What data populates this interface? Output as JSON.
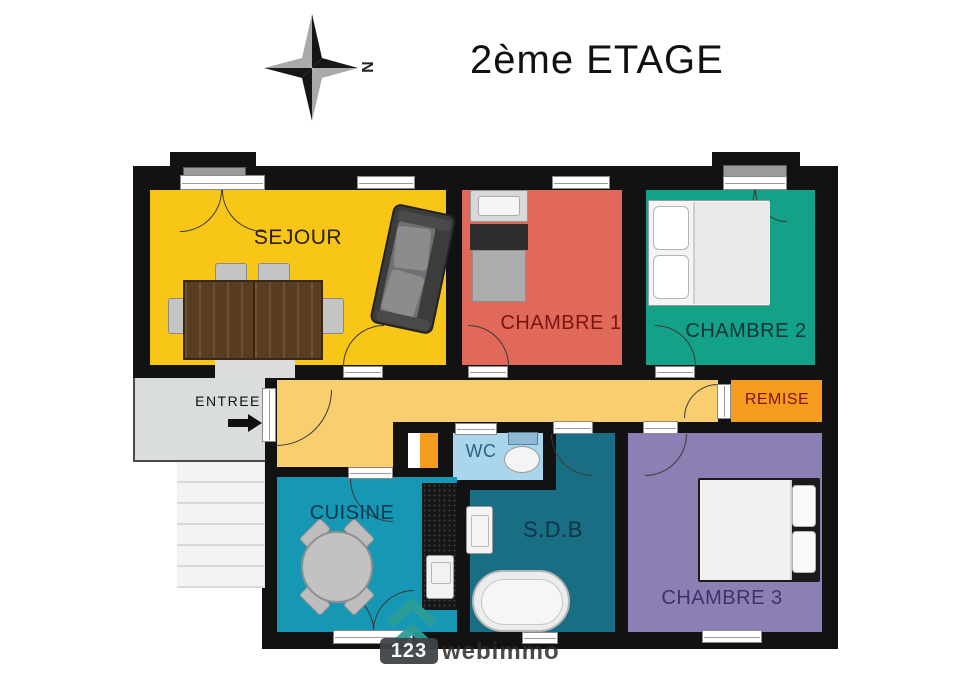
{
  "header": {
    "title": "2ème ETAGE",
    "compass_label": "N"
  },
  "colors": {
    "wall": "#121212",
    "sejour": "#F8C617",
    "hallway": "#F8CE6E",
    "chambre1": "#E0695A",
    "chambre2": "#13A287",
    "remise": "#F59B1E",
    "closet": "#F59B1E",
    "cuisine": "#1697B4",
    "wc": "#A9D6EA",
    "sdb": "#1A6E84",
    "chambre3": "#8C7FB4",
    "entree": "#D9DDDE",
    "watermark_teal": "#2D9E98"
  },
  "label_colors": {
    "sejour": "#2B1E04",
    "chambre1": "#7B150F",
    "chambre2": "#14323B",
    "remise": "#7B150F",
    "entree": "#111111",
    "wc": "#2B6285",
    "cuisine": "#0D3950",
    "sdb": "#0E3448",
    "chambre3": "#43306B"
  },
  "rooms": {
    "sejour": {
      "label": "SEJOUR"
    },
    "chambre1": {
      "label": "CHAMBRE 1"
    },
    "chambre2": {
      "label": "CHAMBRE 2"
    },
    "remise": {
      "label": "REMISE"
    },
    "entree": {
      "label": "ENTREE"
    },
    "wc": {
      "label": "WC"
    },
    "cuisine": {
      "label": "CUISINE"
    },
    "sdb": {
      "label": "S.D.B"
    },
    "chambre3": {
      "label": "CHAMBRE 3"
    }
  },
  "watermark": {
    "number": "123",
    "name": "webimmo"
  }
}
